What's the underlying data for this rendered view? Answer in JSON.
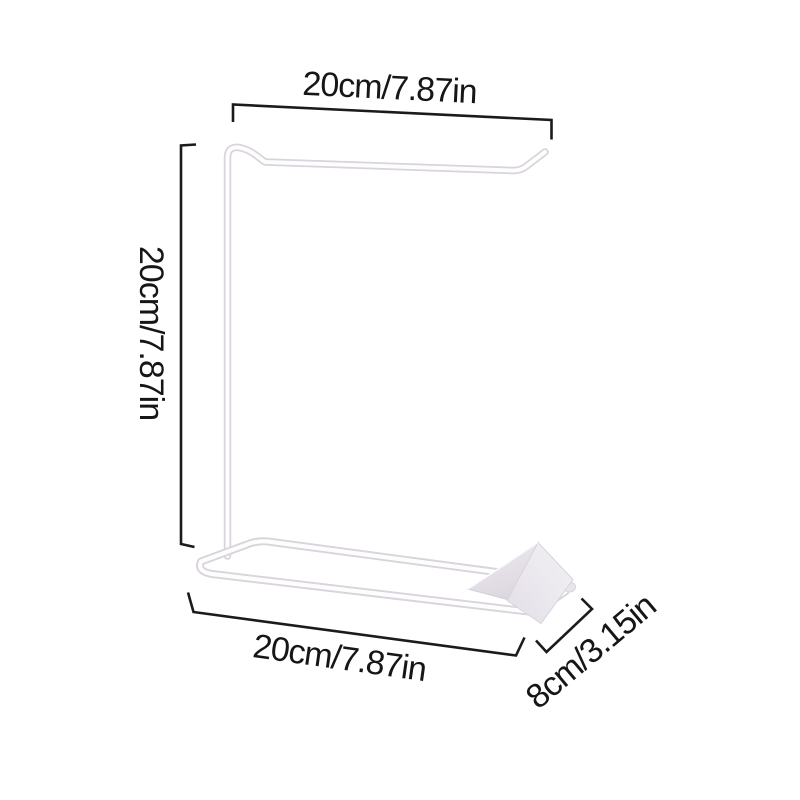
{
  "diagram": {
    "kind": "product-dimension-diagram",
    "product": "white-wire-bag-holder-stand",
    "background_color": "#ffffff",
    "annotation_color": "#1b1b1b",
    "wire_fill_color": "#fefdfe",
    "wire_edge_color": "#d9d3dc",
    "plate_left_face_color": "#e3dee6",
    "plate_right_face_color": "#efecf2",
    "dimensions": {
      "top_width": "20cm/7.87in",
      "height": "20cm/7.87in",
      "base_width": "20cm/7.87in",
      "base_depth": "8cm/3.15in"
    }
  }
}
